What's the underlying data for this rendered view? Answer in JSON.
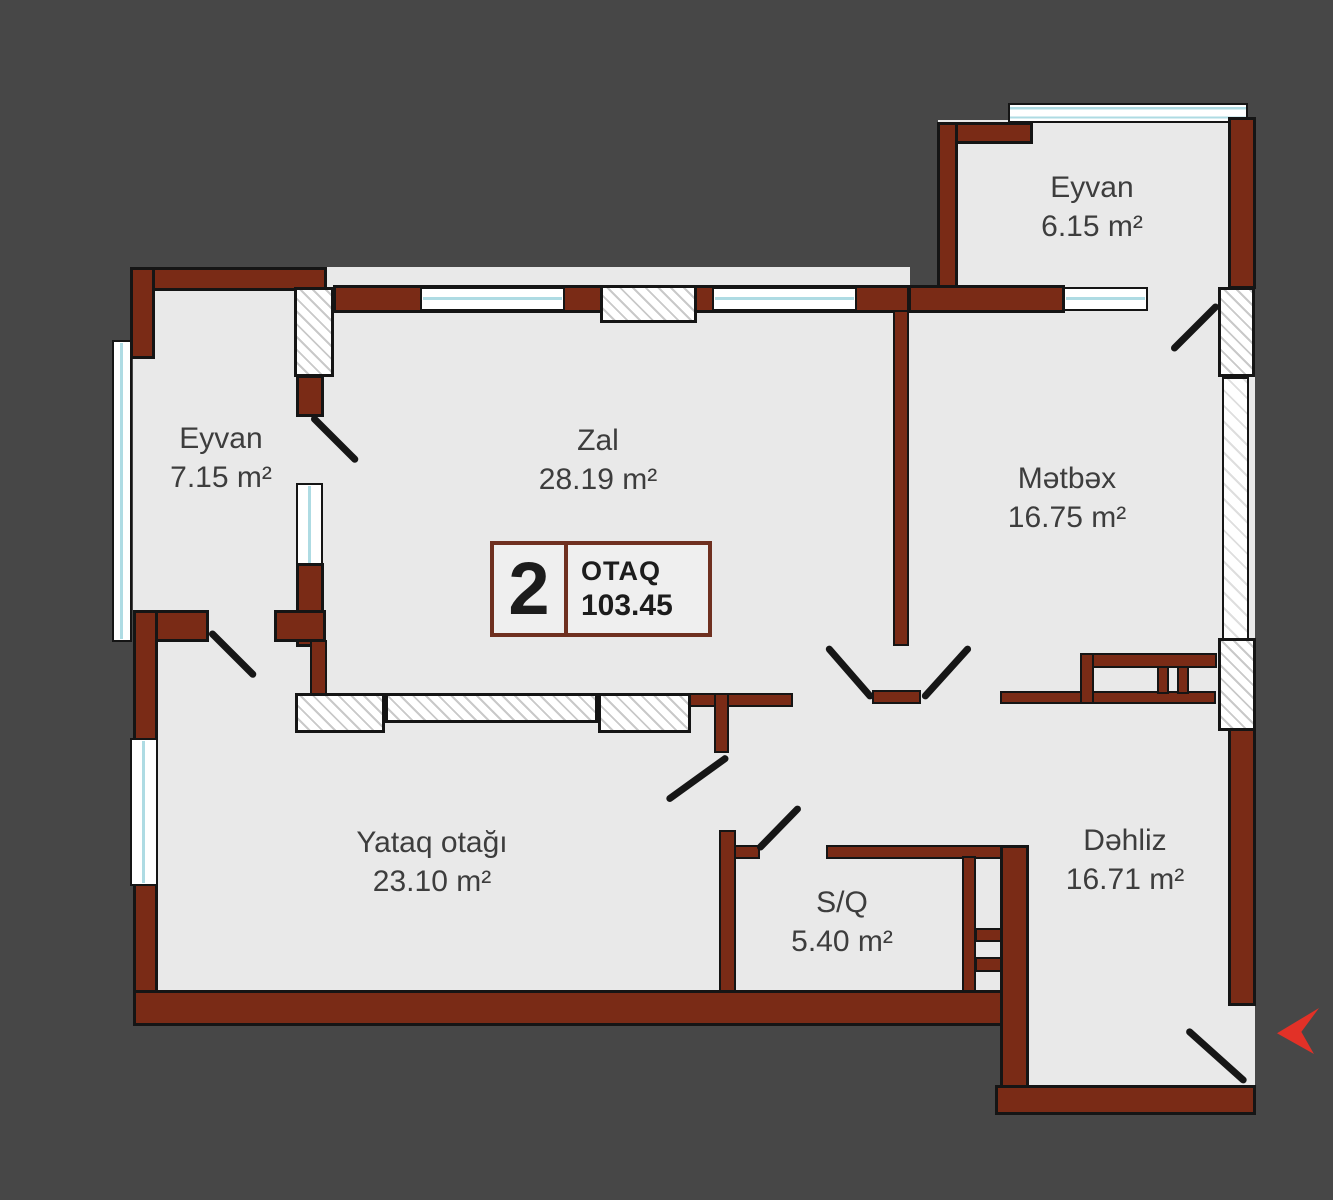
{
  "plan": {
    "type": "apartment-floor-plan",
    "language": "az"
  },
  "badge": {
    "rooms_count": "2",
    "label": "OTAQ",
    "total_area": "103.45"
  },
  "rooms": [
    {
      "id": "eyvan-top",
      "name": "Eyvan",
      "area": "6.15 m²"
    },
    {
      "id": "eyvan-left",
      "name": "Eyvan",
      "area": "7.15 m²"
    },
    {
      "id": "zal",
      "name": "Zal",
      "area": "28.19 m²"
    },
    {
      "id": "metbex",
      "name": "Mətbəx",
      "area": "16.75 m²"
    },
    {
      "id": "yataq",
      "name": "Yataq otağı",
      "area": "23.10 m²"
    },
    {
      "id": "sq",
      "name": "S/Q",
      "area": "5.40 m²"
    },
    {
      "id": "dehliz",
      "name": "Dəhliz",
      "area": "16.71 m²"
    }
  ],
  "colors": {
    "bg": "#474747",
    "wall": "#7a2b16",
    "outline": "#151515",
    "floor": "#e9e9e9",
    "glass": "#aedbe3",
    "door": "#161616",
    "arrow": "#e23127",
    "text": "#3d3d3d",
    "badge-border": "#6f3020",
    "badge-bg": "#efefef"
  }
}
